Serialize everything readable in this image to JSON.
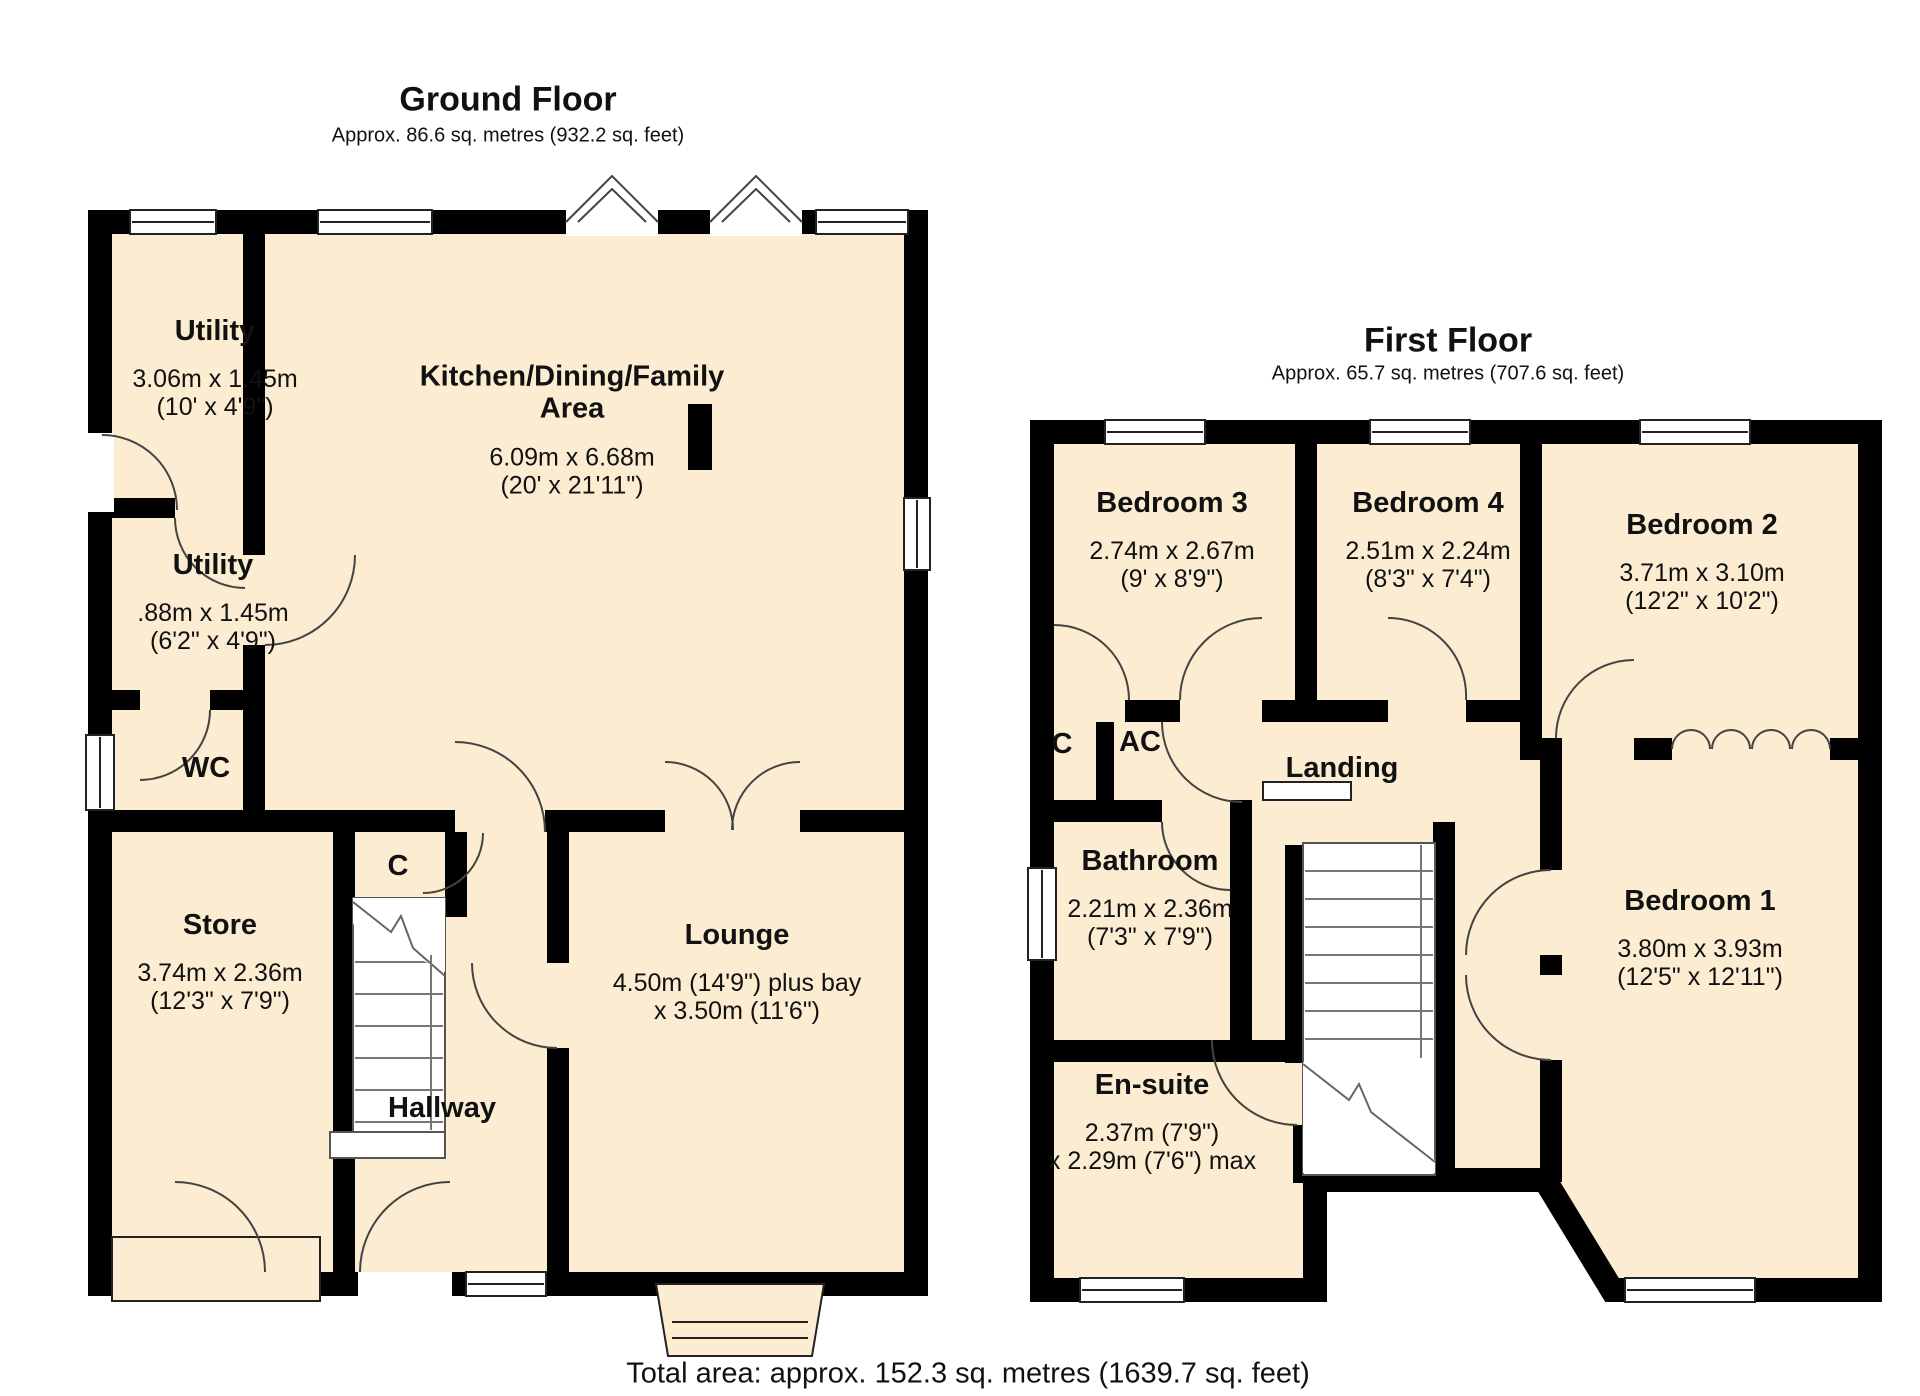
{
  "colors": {
    "wall": "#000000",
    "room_fill": "#fcecd2",
    "background": "#ffffff",
    "text": "#111111"
  },
  "ground_floor": {
    "title": "Ground Floor",
    "subtitle": "Approx. 86.6 sq. metres (932.2 sq. feet)",
    "rooms": {
      "utility_top": {
        "name": "Utility",
        "dims": "3.06m x 1.45m\n(10' x 4'9\")"
      },
      "kitchen": {
        "name": "Kitchen/Dining/Family\nArea",
        "dims": "6.09m x 6.68m\n(20' x 21'11\")"
      },
      "utility_lower": {
        "name": "Utility",
        "dims": ".88m x 1.45m\n(6'2\" x 4'9\")"
      },
      "wc": {
        "name": "WC"
      },
      "store": {
        "name": "Store",
        "dims": "3.74m x 2.36m\n(12'3\" x 7'9\")"
      },
      "closet": {
        "name": "C"
      },
      "hallway": {
        "name": "Hallway"
      },
      "lounge": {
        "name": "Lounge",
        "dims": "4.50m (14'9\") plus bay\nx 3.50m (11'6\")"
      }
    }
  },
  "first_floor": {
    "title": "First Floor",
    "subtitle": "Approx. 65.7 sq. metres (707.6 sq. feet)",
    "rooms": {
      "bedroom3": {
        "name": "Bedroom 3",
        "dims": "2.74m x 2.67m\n(9' x 8'9\")"
      },
      "bedroom4": {
        "name": "Bedroom 4",
        "dims": "2.51m x 2.24m\n(8'3\" x 7'4\")"
      },
      "bedroom2": {
        "name": "Bedroom 2",
        "dims": "3.71m x 3.10m\n(12'2\" x 10'2\")"
      },
      "closet": {
        "name": "C"
      },
      "airing_cupboard": {
        "name": "AC"
      },
      "landing": {
        "name": "Landing"
      },
      "bathroom": {
        "name": "Bathroom",
        "dims": "2.21m x 2.36m\n(7'3\" x 7'9\")"
      },
      "bedroom1": {
        "name": "Bedroom 1",
        "dims": "3.80m x 3.93m\n(12'5\" x 12'11\")"
      },
      "ensuite": {
        "name": "En-suite",
        "dims": "2.37m (7'9\")\nx 2.29m (7'6\") max"
      }
    }
  },
  "footer": {
    "total_area": "Total area: approx. 152.3 sq. metres (1639.7 sq. feet)"
  }
}
